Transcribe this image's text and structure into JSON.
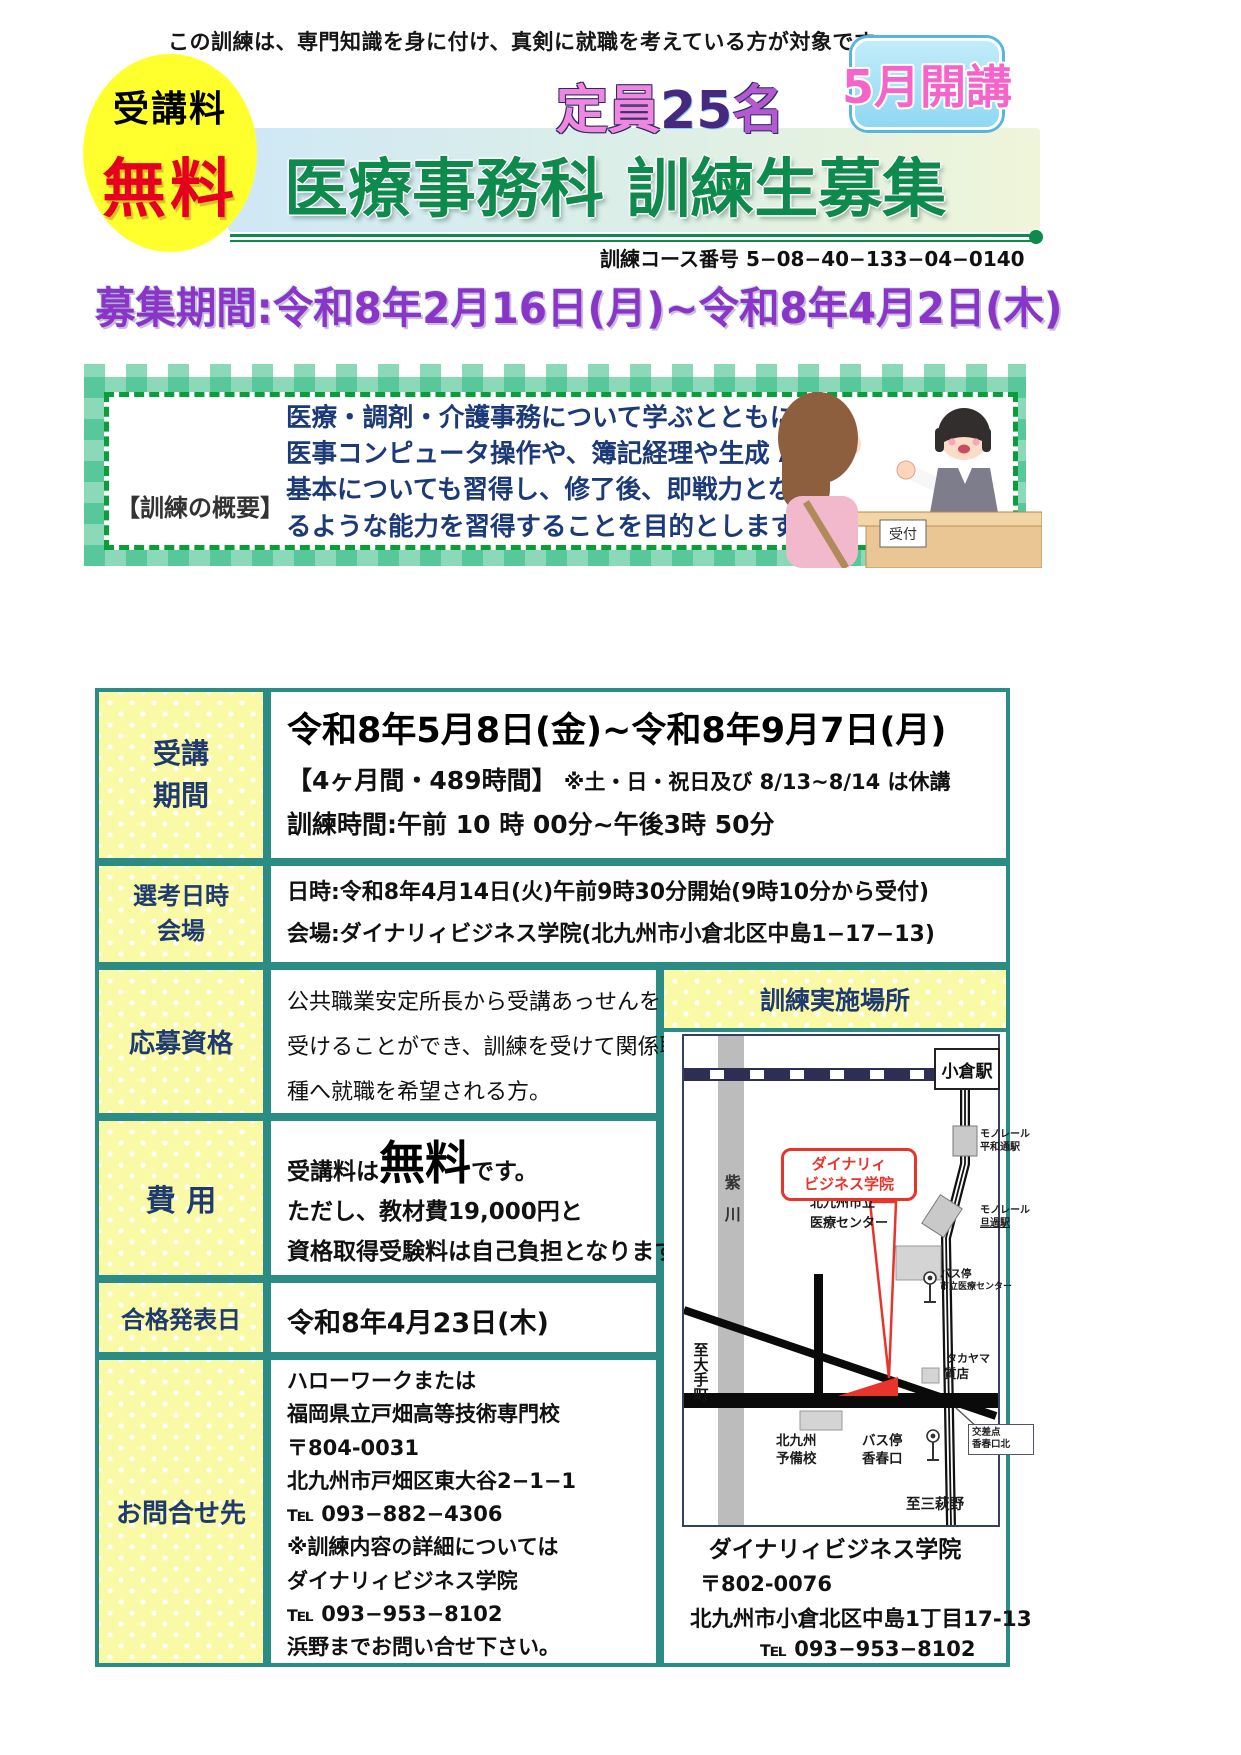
{
  "colors": {
    "teal": "#2b8c85",
    "label_yellow": "#f9f9a6",
    "navy": "#1e3a6e",
    "title_green": "#0e8a4c",
    "banner_purple": "#8a35c8",
    "free_red": "#e60020",
    "circle_yellow": "#ffff2e",
    "badge_blue": "#8fd8f2",
    "badge_pink": "#f564c8",
    "bubble_red": "#e8342a",
    "overview_blue": "#1c3a78",
    "gingham_green": "rgba(46,186,130,0.55)"
  },
  "page": {
    "tagline": "この訓練は、専門知識を身に付け、真剣に就職を考えている方が対象です。",
    "fee_circle": {
      "top": "受講料",
      "main": "無料"
    },
    "capacity_parts": [
      "定員",
      "25",
      "名"
    ],
    "month_badge": "5月開講",
    "title": "医療事務科 訓練生募集",
    "course_no": "訓練コース番号 5−08−40−133−04−0140",
    "period_banner": "募集期間:令和8年2月16日(月)~令和8年4月2日(木)"
  },
  "overview": {
    "label": "【訓練の概要】",
    "lines": [
      "医療・調剤・介護事務について学ぶとともに、",
      "医事コンピュータ操作や、簿記経理や生成 AI の",
      "基本についても習得し、修了後、即戦力となれ",
      "るような能力を習得することを目的とします。"
    ],
    "reception_sign": "受付"
  },
  "table": {
    "period": {
      "label_lines": [
        "受講",
        "期間"
      ],
      "dates": "令和8年5月8日(金)~令和8年9月7日(月)",
      "duration": "【4ヶ月間・489時間】",
      "duration_note": " ※土・日・祝日及び 8/13~8/14 は休講",
      "hours": "訓練時間:午前 10 時 00分~午後3時 50分"
    },
    "selection": {
      "label_lines": [
        "選考日時",
        "会場"
      ],
      "datetime": "日時:令和8年4月14日(火)午前9時30分開始(9時10分から受付)",
      "venue": "会場:ダイナリィビジネス学院(北九州市小倉北区中島1−17−13)"
    },
    "eligibility": {
      "label": "応募資格",
      "lines": [
        "公共職業安定所長から受講あっせんを",
        "受けることができ、訓練を受けて関係職",
        "種へ就職を希望される方。"
      ]
    },
    "cost": {
      "label": "費 用",
      "free_prefix": "受講料は",
      "free_word": "無料",
      "free_suffix": "です。",
      "note1": "ただし、教材費19,000円と",
      "note2": "資格取得受験料は自己負担となります。"
    },
    "announce": {
      "label": "合格発表日",
      "value": "令和8年4月23日(木)"
    },
    "contact": {
      "label": "お問合せ先",
      "lines": [
        "ハローワークまたは",
        "福岡県立戸畑高等技術専門校",
        "〒804-0031",
        "北九州市戸畑区東大谷2−1−1",
        "℡ 093−882−4306",
        "※訓練内容の詳細については",
        "ダイナリィビジネス学院",
        "℡ 093−953−8102",
        "浜野までお問い合せ下さい。"
      ]
    }
  },
  "location": {
    "header": "訓練実施場所",
    "map": {
      "kokura_station": "小倉駅",
      "river": "紫川",
      "heiwadori": [
        "モノレール",
        "平和通駅"
      ],
      "tanga": [
        "モノレール",
        "旦過駅"
      ],
      "medical_center": [
        "北九州市立",
        "医療センター"
      ],
      "bus_medical": [
        "バス停",
        "市立医療センター"
      ],
      "takayama": [
        "タカヤマ",
        "質店"
      ],
      "school_bubble": [
        "ダイナリィ",
        "ビジネス学院"
      ],
      "to_otemachi": "至大手町",
      "yobiko": [
        "北九州",
        "予備校"
      ],
      "bus_kawaraguchi": [
        "バス停",
        "香春口"
      ],
      "intersection": [
        "交差点",
        "香春口北"
      ],
      "to_mihagino": "至三萩野"
    },
    "address": {
      "name": "ダイナリィビジネス学院",
      "postal": "〒802-0076",
      "street": "北九州市小倉北区中島1丁目17-13",
      "tel": "℡ 093−953−8102"
    }
  }
}
